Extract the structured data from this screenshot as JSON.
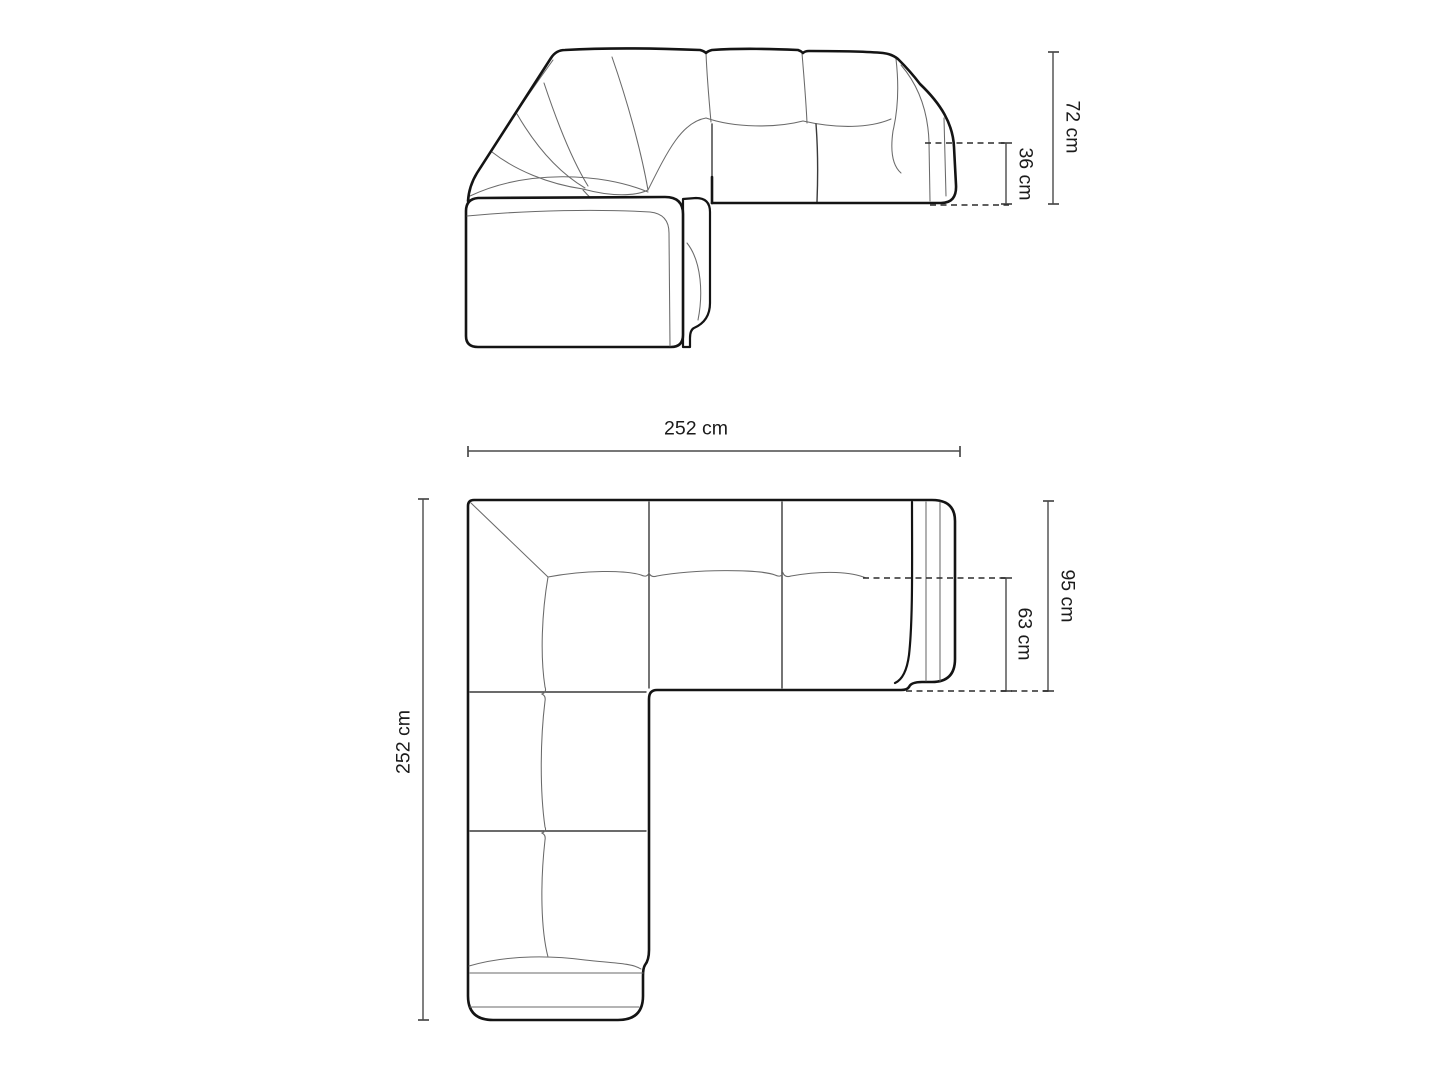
{
  "diagram_title": "Corner sofa dimensions diagram",
  "front_view": {
    "total_height_label": "72 cm",
    "seat_height_label": "36 cm"
  },
  "top_view": {
    "total_width_label": "252 cm",
    "total_length_label": "252 cm",
    "total_depth_label": "95 cm",
    "seat_depth_label": "63 cm"
  },
  "colors": {
    "background": "#ffffff",
    "outline": "#141414",
    "detail_lines": "#6a6a6a",
    "dimension_lines": "#4a4a4a",
    "dashed_lines": "#2b2b2b",
    "text": "#1b1b1b"
  }
}
